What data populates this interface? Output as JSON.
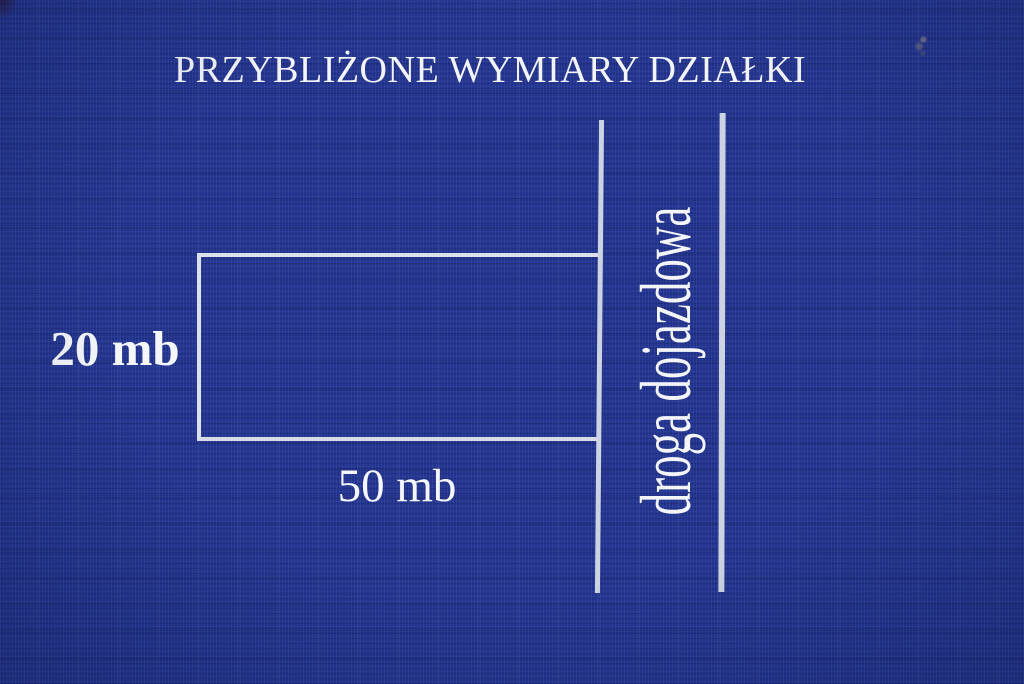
{
  "title": "PRZYBLIŻONE WYMIARY DZIAŁKI",
  "plot": {
    "height_label": "20 mb",
    "width_label": "50 mb"
  },
  "road": {
    "label": "droga dojazdowa"
  },
  "colors": {
    "background": "#22348f",
    "lines": "#ccd3e2",
    "text": "#f5f6fa"
  }
}
